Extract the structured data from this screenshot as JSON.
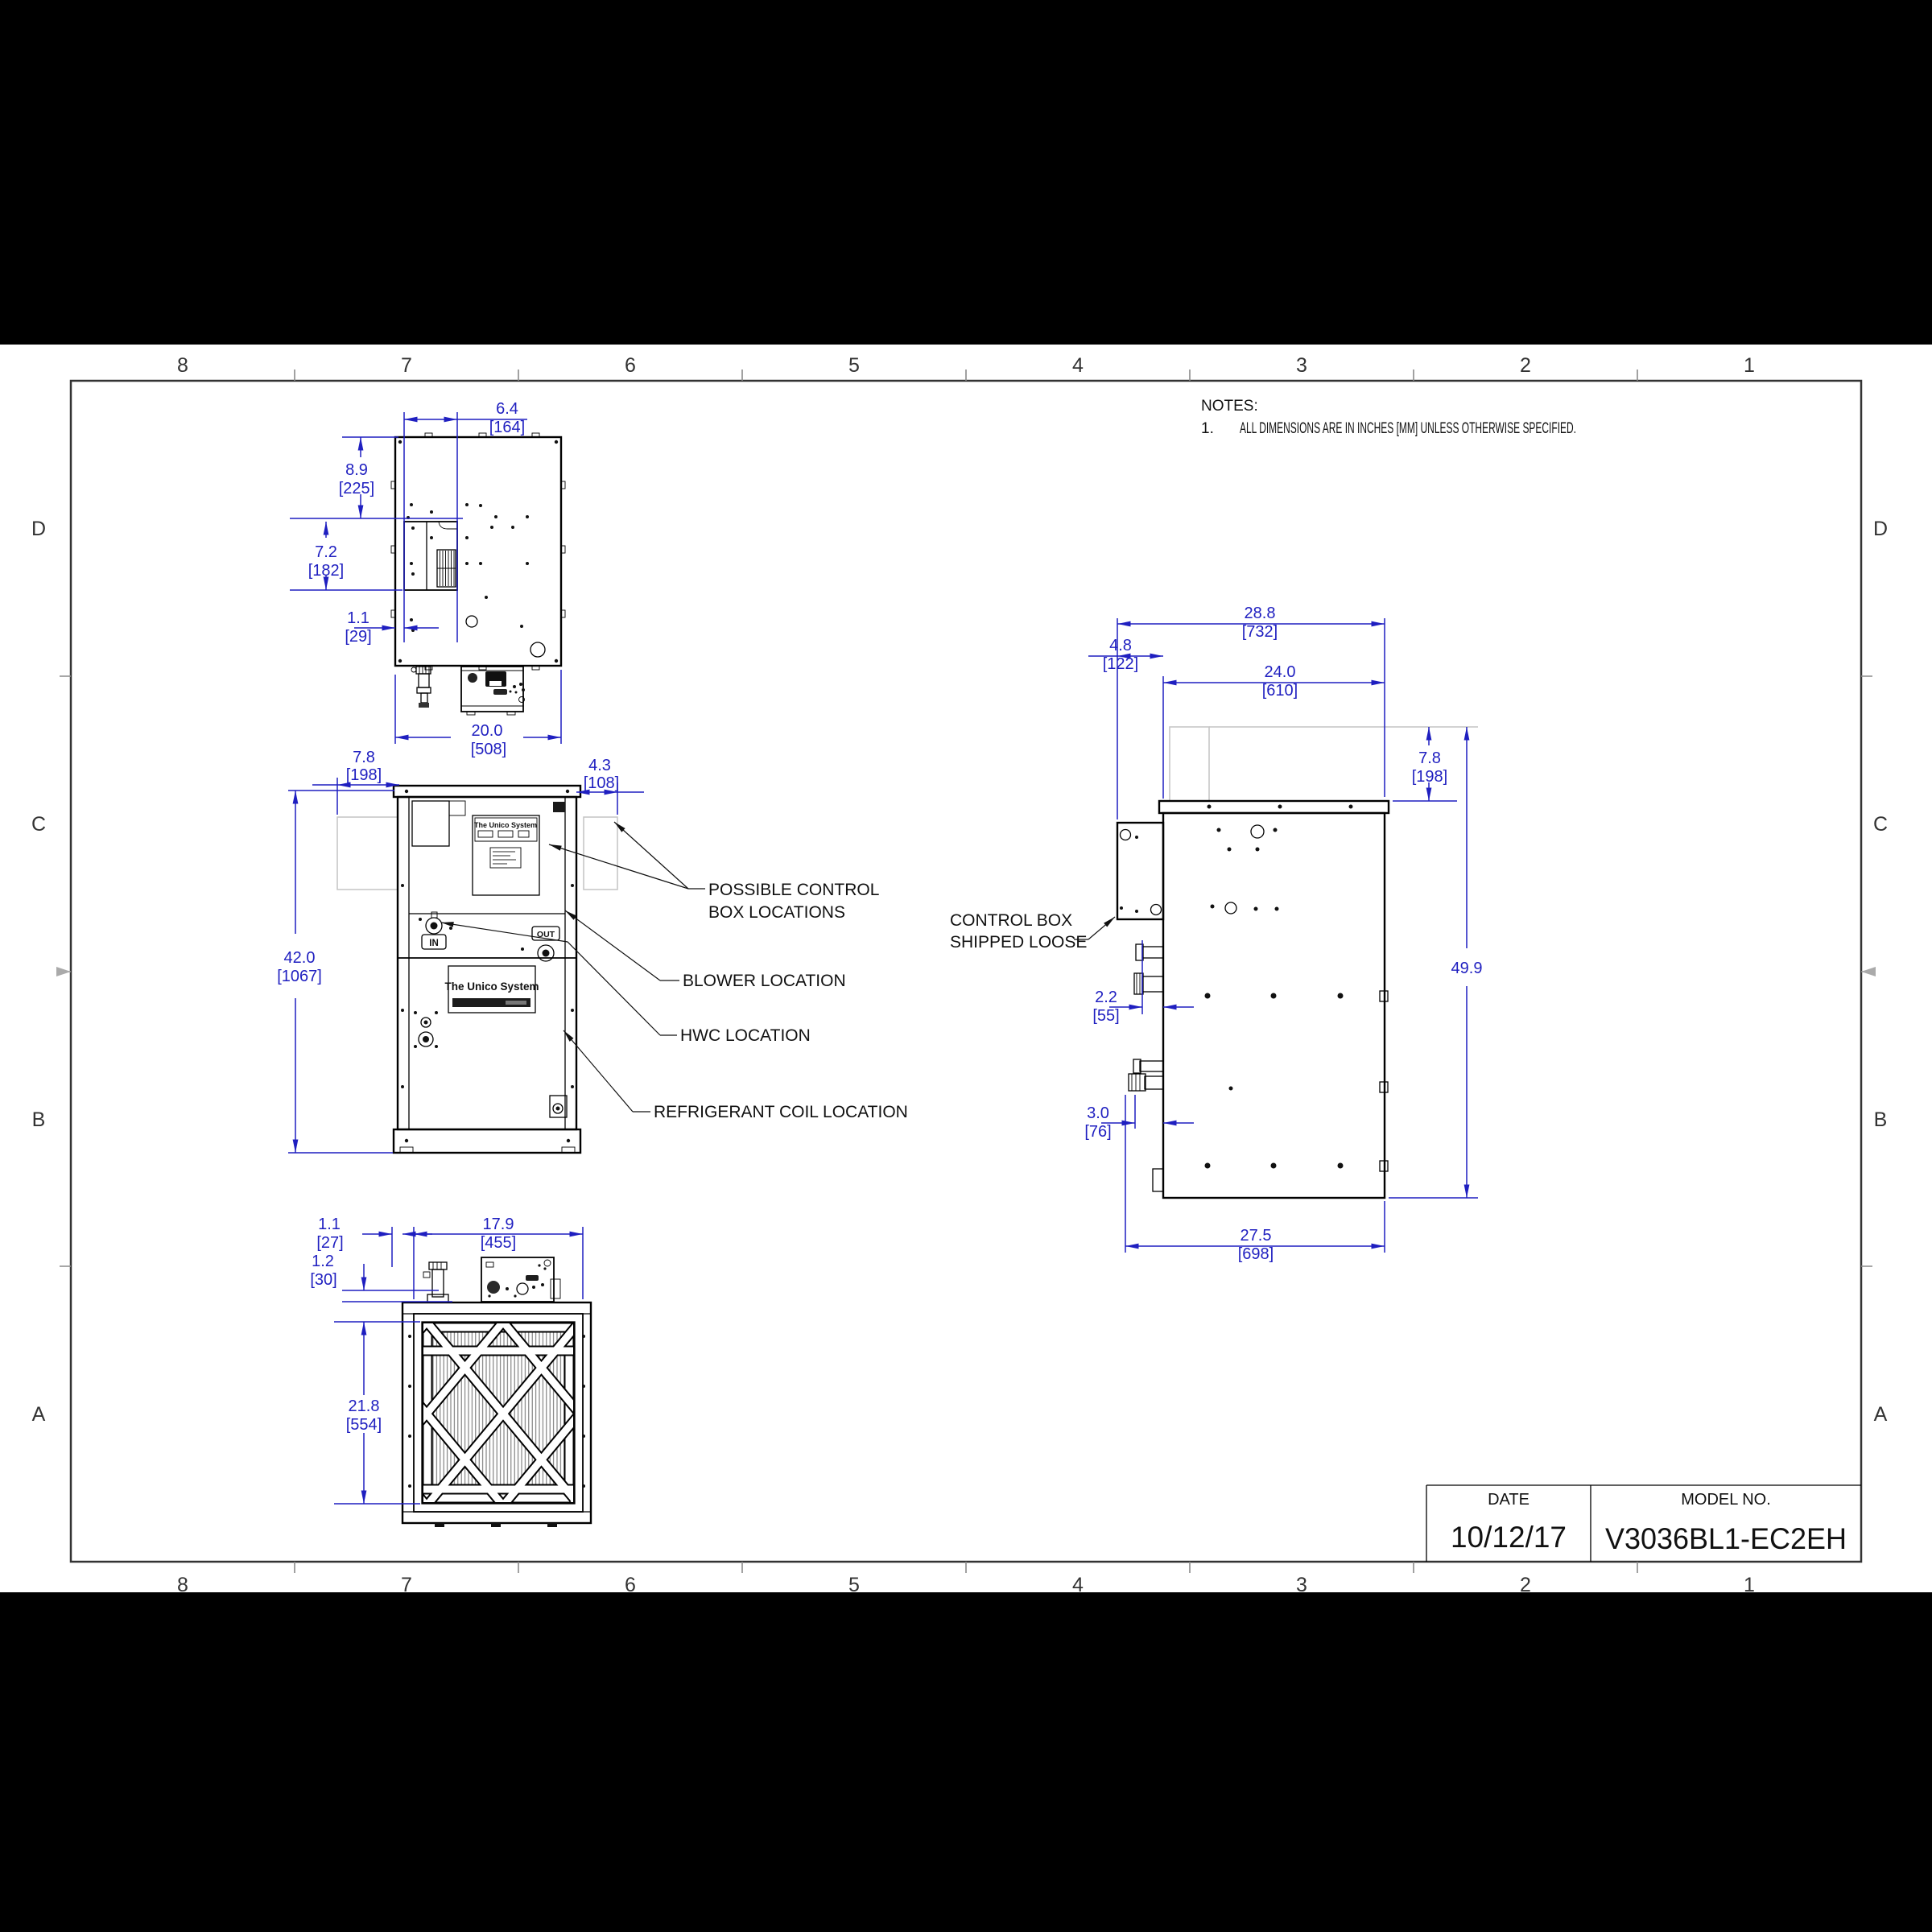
{
  "sheet": {
    "background": "#000000",
    "paper_color": "#ffffff",
    "accent_blue": "#1f1fc0",
    "border": {
      "columns": [
        "8",
        "7",
        "6",
        "5",
        "4",
        "3",
        "2",
        "1"
      ],
      "rows": [
        "D",
        "C",
        "B",
        "A"
      ]
    },
    "notes": {
      "title": "NOTES:",
      "item_number": "1.",
      "item_text": "ALL DIMENSIONS ARE IN INCHES [MM] UNLESS OTHERWISE SPECIFIED."
    },
    "title_block": {
      "date_label": "DATE",
      "date_value": "10/12/17",
      "model_label": "MODEL NO.",
      "model_value": "V3036BL1-EC2EH"
    }
  },
  "callouts": {
    "possible_control_box_line1": "POSSIBLE CONTROL",
    "possible_control_box_line2": "BOX LOCATIONS",
    "blower": "BLOWER LOCATION",
    "hwc": "HWC LOCATION",
    "refrigerant_coil": "REFRIGERANT COIL LOCATION",
    "control_box_line1": "CONTROL BOX",
    "control_box_line2": "SHIPPED LOOSE"
  },
  "ports": {
    "in_label": "IN",
    "out_label": "OUT"
  },
  "brand": {
    "logo_text": "The Unico System"
  },
  "dimensions": {
    "top_view": {
      "width_upper": {
        "in": "6.4",
        "mm": "[164]"
      },
      "depth_upper": {
        "in": "8.9",
        "mm": "[225]"
      },
      "box_height": {
        "in": "7.2",
        "mm": "[182]"
      },
      "offset_left": {
        "in": "1.1",
        "mm": "[29]"
      },
      "width_total": {
        "in": "20.0",
        "mm": "[508]"
      }
    },
    "front_view": {
      "left_box_offset": {
        "in": "7.8",
        "mm": "[198]"
      },
      "right_box_offset": {
        "in": "4.3",
        "mm": "[108]"
      },
      "height_total": {
        "in": "42.0",
        "mm": "[1067]"
      }
    },
    "bottom_view": {
      "offset_left": {
        "in": "1.1",
        "mm": "[27]"
      },
      "rail_height": {
        "in": "1.2",
        "mm": "[30]"
      },
      "filter_width": {
        "in": "17.9",
        "mm": "[455]"
      },
      "filter_height": {
        "in": "21.8",
        "mm": "[554]"
      }
    },
    "side_view": {
      "depth_total": {
        "in": "28.8",
        "mm": "[732]"
      },
      "control_box_depth": {
        "in": "4.8",
        "mm": "[122]"
      },
      "cabinet_depth": {
        "in": "24.0",
        "mm": "[610]"
      },
      "control_box_height": {
        "in": "7.8",
        "mm": "[198]"
      },
      "height_overall": {
        "in": "49.9",
        "mm": ""
      },
      "pipe_offset_upper": {
        "in": "2.2",
        "mm": "[55]"
      },
      "pipe_offset_lower": {
        "in": "3.0",
        "mm": "[76]"
      },
      "base_depth": {
        "in": "27.5",
        "mm": "[698]"
      }
    }
  }
}
